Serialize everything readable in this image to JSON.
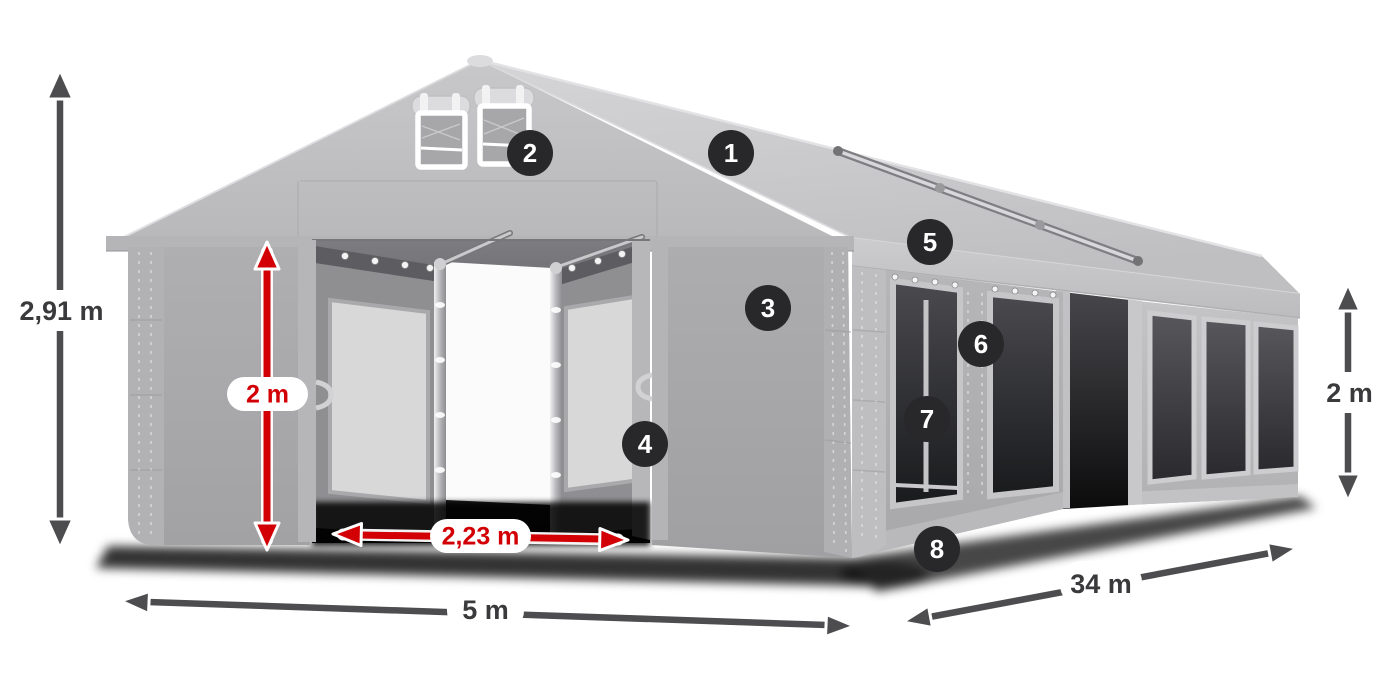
{
  "diagram": {
    "subject": "marquee-tent-dimension-diagram",
    "dimensions": {
      "total_height": "2,91 m",
      "entrance_height": "2 m",
      "entrance_width": "2,23 m",
      "front_width": "5 m",
      "side_length": "34 m",
      "side_wall_height": "2 m"
    },
    "badges": [
      "1",
      "2",
      "3",
      "4",
      "5",
      "6",
      "7",
      "8"
    ],
    "colors": {
      "measure_arrow": "#4d4d50",
      "measure_text": "#3a3a3c",
      "accent_red": "#d20005",
      "badge_background": "#28282a",
      "badge_text": "#ffffff",
      "label_background": "#ffffff",
      "tent_fabric_light": "#c9c9cb",
      "tent_fabric_mid": "#b0b0b2",
      "window_tint": "#3f3f44"
    }
  }
}
